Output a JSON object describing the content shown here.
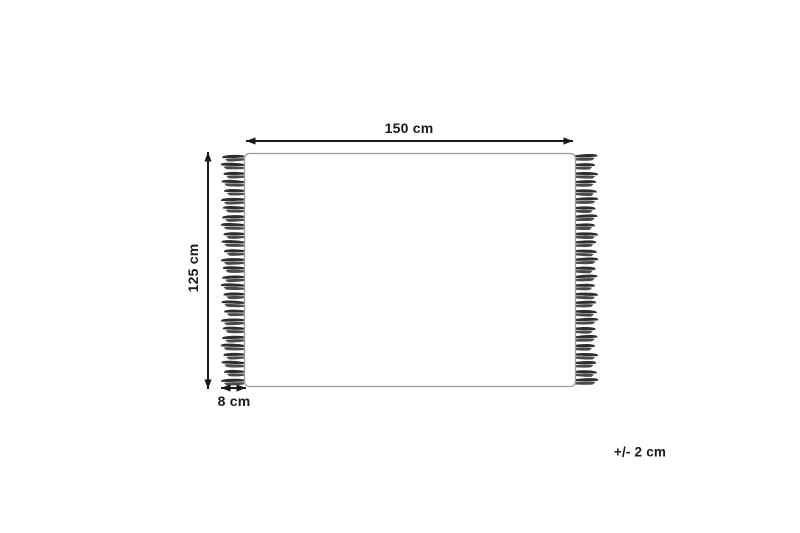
{
  "diagram": {
    "name": "rug-dimension-diagram",
    "labels": {
      "width": "150 cm",
      "height": "125 cm",
      "fringe": "8 cm",
      "tolerance": "+/- 2 cm"
    },
    "colors": {
      "background": "#ffffff",
      "outline": "#9b9b9b",
      "arrow": "#1a1a1a",
      "tassel_dark": "#2e2e2e",
      "tassel_light": "#4a4a4a",
      "text": "#1a1a1a"
    },
    "fringe": {
      "tassels_per_side": 27,
      "sides": [
        "left",
        "right"
      ]
    }
  }
}
